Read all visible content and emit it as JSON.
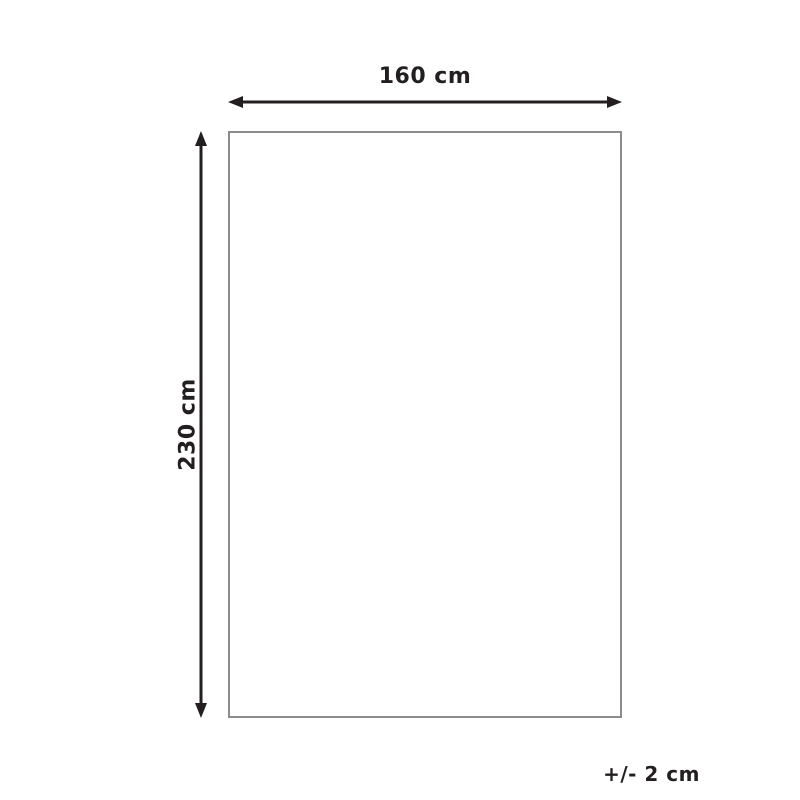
{
  "diagram": {
    "type": "product-dimension-diagram",
    "width_label": "160 cm",
    "height_label": "230 cm",
    "tolerance_label": "+/- 2 cm",
    "colors": {
      "arrow": "#231f20",
      "text": "#231f20",
      "rectangle_border": "#8c8c8c",
      "background": "#ffffff"
    }
  }
}
